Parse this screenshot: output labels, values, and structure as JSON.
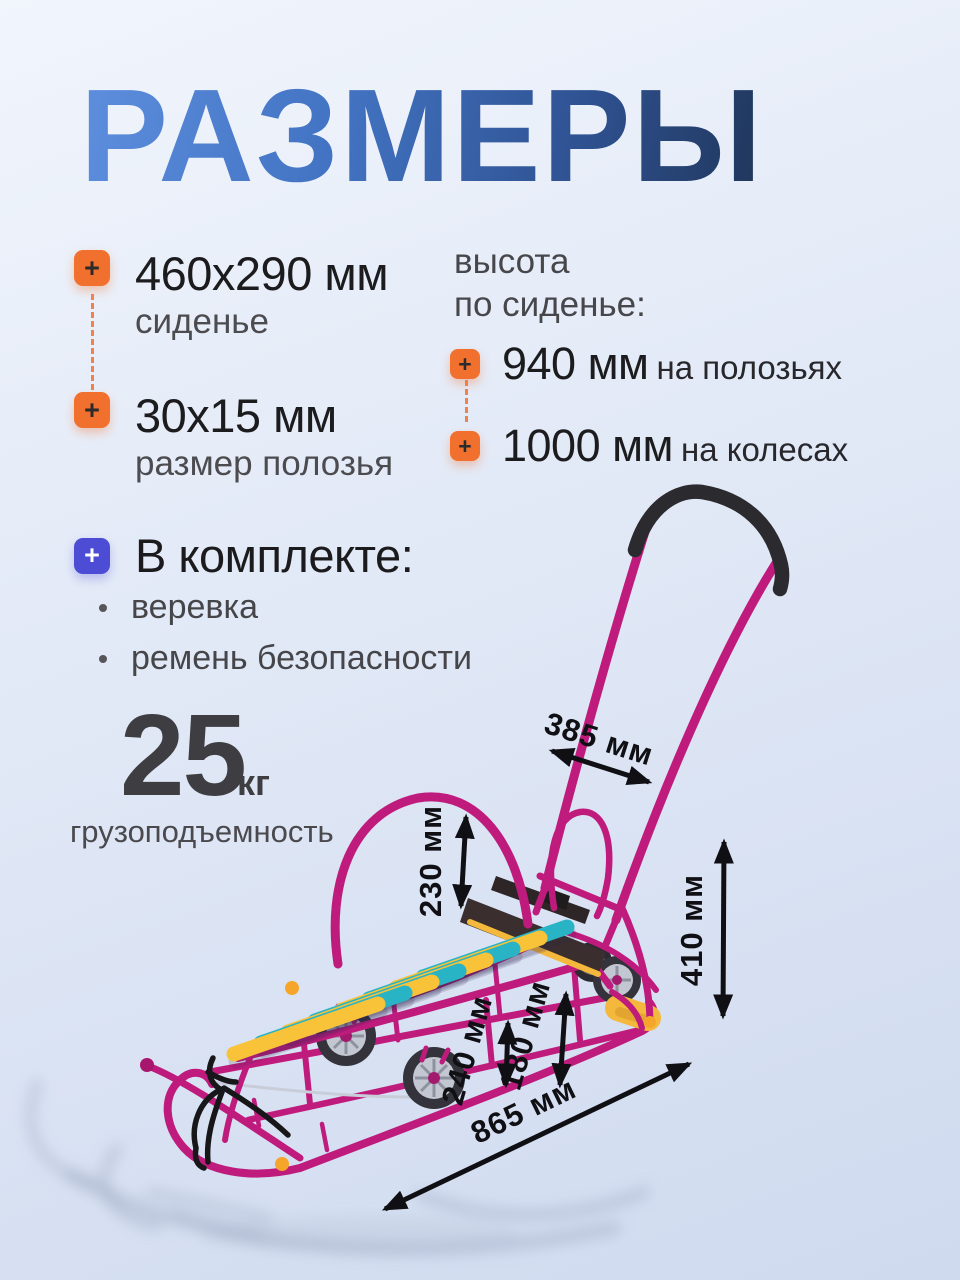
{
  "title": "РАЗМЕРЫ",
  "plus_symbol": "+",
  "left_specs": [
    {
      "icon": "plus",
      "value": "460x290 мм",
      "label": "сиденье"
    },
    {
      "icon": "plus",
      "value": "30x15 мм",
      "label": "размер полозья"
    }
  ],
  "seat_height": {
    "heading_line1": "высота",
    "heading_line2": "по сиденье:",
    "items": [
      {
        "icon": "plus",
        "value": "940 мм",
        "suffix": "на полозьях"
      },
      {
        "icon": "plus",
        "value": "1000 мм",
        "suffix": "на колесах"
      }
    ]
  },
  "included": {
    "icon": "plus",
    "heading": "В комплекте:",
    "items": [
      "веревка",
      "ремень безопасности"
    ]
  },
  "capacity": {
    "value": "25",
    "unit": "кг",
    "label": "грузоподъемность"
  },
  "dimensions": {
    "handle_width": "385 мм",
    "backrest_height": "230 мм",
    "rear_height": "410 мм",
    "seat_front_height": "240 мм",
    "seat_rear_height": "180 мм",
    "length": "865 мм"
  },
  "colors": {
    "accent_orange": "#F2702D",
    "accent_indigo": "#4D4CD5",
    "title_gradient_start": "#5E8EDE",
    "title_gradient_end": "#20365A",
    "frame_magenta": "#BF1B7D",
    "slat_cyan": "#29B4C6",
    "slat_yellow": "#F8C239",
    "dimension_ink": "#101014"
  }
}
